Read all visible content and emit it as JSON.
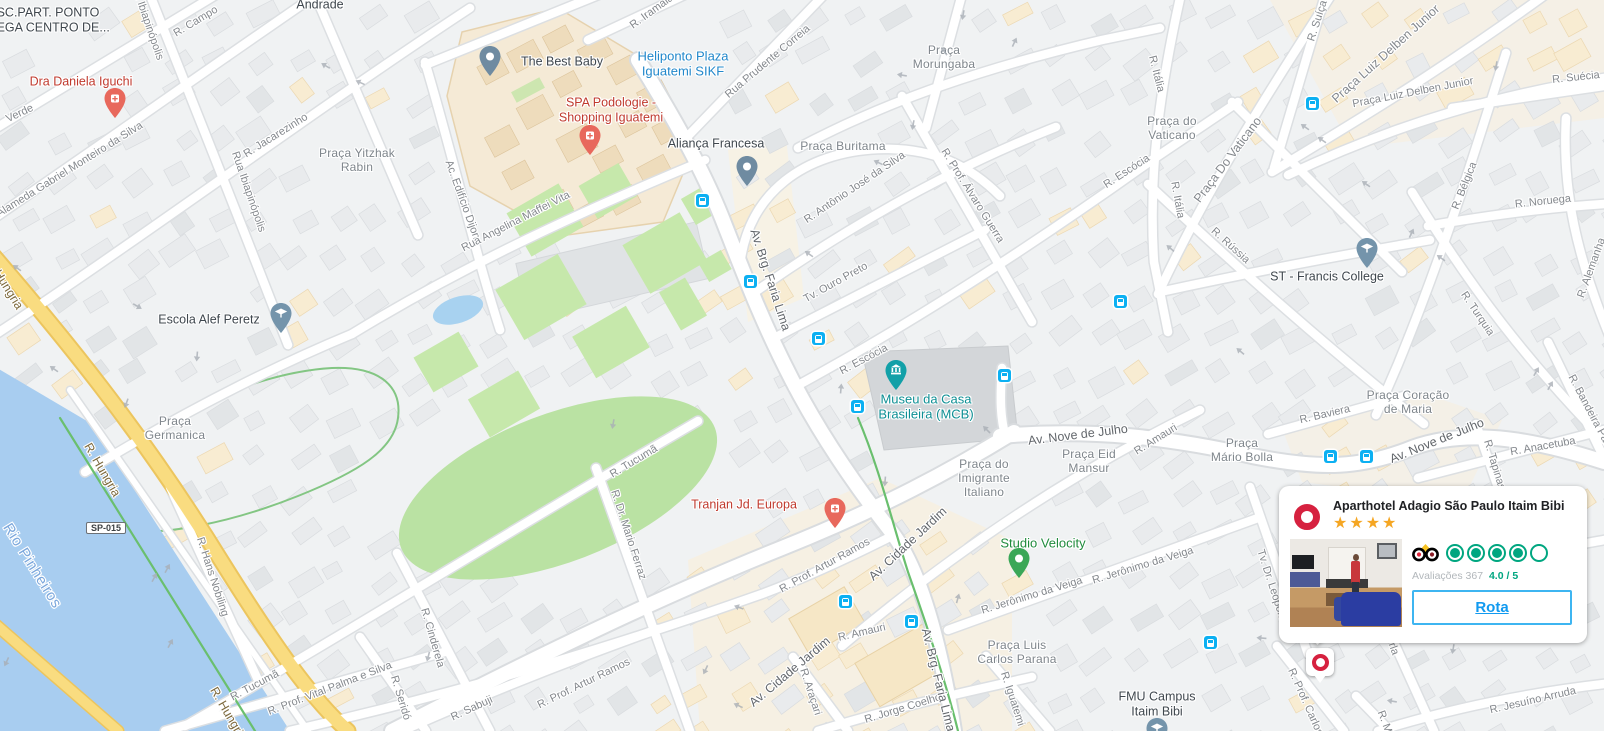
{
  "map": {
    "colors": {
      "land": "#f0f2f3",
      "water": "#a8cdf0",
      "park": "#bae2a3",
      "road_yellow": "#f9dc80",
      "transit_blue": "#0cb0f2",
      "poi_red": "#c03a2e",
      "poi_blue": "#2288cb",
      "poi_teal": "#0e8f94",
      "poi_green": "#208b3d",
      "pin_health": "#e8685c",
      "pin_gray": "#6f8ba1",
      "pin_school": "#7494ab",
      "pin_museum": "#12a0a8",
      "pin_green": "#3aa757",
      "adagio_red": "#d6213f"
    },
    "route_shield": {
      "text": "SP-015",
      "x": 106,
      "y": 528
    },
    "labels": [
      {
        "t": "R. Campo",
        "x": 196,
        "y": 22,
        "rot": -31,
        "cls": "st"
      },
      {
        "t": "Verde",
        "x": 20,
        "y": 114,
        "rot": -25,
        "cls": "st"
      },
      {
        "t": "Alameda Gabriel Monteiro da Silva",
        "x": 70,
        "y": 170,
        "rot": -32,
        "cls": "st"
      },
      {
        "t": "R. Jacarezinho",
        "x": 276,
        "y": 136,
        "rot": -32,
        "cls": "st"
      },
      {
        "t": "Rua Ibiapinópolis",
        "x": 248,
        "y": 192,
        "rot": 71,
        "cls": "st"
      },
      {
        "t": "Rua Ibiapinópolis",
        "x": 146,
        "y": 20,
        "rot": 71,
        "cls": "st"
      },
      {
        "t": "Ac. Edifício Dijon",
        "x": 462,
        "y": 200,
        "rot": 70,
        "cls": "st"
      },
      {
        "t": "Rua Angelina Maffei Vita",
        "x": 516,
        "y": 222,
        "rot": -27,
        "cls": "st"
      },
      {
        "t": "R. Iramaia",
        "x": 652,
        "y": 12,
        "rot": -36,
        "cls": "st"
      },
      {
        "t": "Rua Prudente Correia",
        "x": 768,
        "y": 62,
        "rot": -40,
        "cls": "st"
      },
      {
        "t": "R. Antônio José da Silva",
        "x": 855,
        "y": 188,
        "rot": -34,
        "cls": "st"
      },
      {
        "t": "R. Prof. Álvaro Guerra",
        "x": 972,
        "y": 196,
        "rot": 58,
        "cls": "st"
      },
      {
        "t": "Tv. Ouro Preto",
        "x": 836,
        "y": 283,
        "rot": -29,
        "cls": "st"
      },
      {
        "t": "R. Escócia",
        "x": 864,
        "y": 360,
        "rot": -28,
        "cls": "st"
      },
      {
        "t": "R. Escócia",
        "x": 1127,
        "y": 172,
        "rot": -33,
        "cls": "st"
      },
      {
        "t": "R. Rússia",
        "x": 1230,
        "y": 246,
        "rot": 42,
        "cls": "st"
      },
      {
        "t": "R. Itália",
        "x": 1156,
        "y": 74,
        "rot": 76,
        "cls": "st"
      },
      {
        "t": "R. Itália",
        "x": 1177,
        "y": 200,
        "rot": 80,
        "cls": "st"
      },
      {
        "t": "Praça Do Vaticano",
        "x": 1228,
        "y": 160,
        "rot": -53,
        "fs": 12.5,
        "cls": "st"
      },
      {
        "t": "Praça Luiz Delben Junior",
        "x": 1386,
        "y": 54,
        "rot": -42,
        "fs": 12.5,
        "cls": "st"
      },
      {
        "t": "Praça Luiz Delben Junior",
        "x": 1413,
        "y": 93,
        "rot": -11,
        "cls": "st"
      },
      {
        "t": "R. Suíça",
        "x": 1318,
        "y": 21,
        "rot": -72,
        "cls": "st"
      },
      {
        "t": "R. Suécia",
        "x": 1576,
        "y": 78,
        "rot": -6,
        "cls": "st"
      },
      {
        "t": "R. Bélgica",
        "x": 1465,
        "y": 186,
        "rot": -68,
        "cls": "st"
      },
      {
        "t": "R. Noruega",
        "x": 1543,
        "y": 202,
        "rot": -6,
        "cls": "st"
      },
      {
        "t": "R. Turquia",
        "x": 1477,
        "y": 314,
        "rot": 56,
        "cls": "st"
      },
      {
        "t": "R. Alemanha",
        "x": 1592,
        "y": 268,
        "rot": -70,
        "cls": "st"
      },
      {
        "t": "R. Baviera",
        "x": 1325,
        "y": 415,
        "rot": -13,
        "cls": "st"
      },
      {
        "t": "R. Amauri",
        "x": 1156,
        "y": 440,
        "rot": -32,
        "cls": "st"
      },
      {
        "t": "R. Amauri",
        "x": 862,
        "y": 633,
        "rot": -13,
        "cls": "st"
      },
      {
        "t": "R. Jerônimo da Veiga",
        "x": 1032,
        "y": 596,
        "rot": -17,
        "cls": "st"
      },
      {
        "t": "R. Jerônimo da Veiga",
        "x": 1143,
        "y": 566,
        "rot": -17,
        "cls": "st"
      },
      {
        "t": "R. Iguatemi",
        "x": 1012,
        "y": 699,
        "rot": 72,
        "cls": "st"
      },
      {
        "t": "R. Araçari",
        "x": 810,
        "y": 692,
        "rot": 72,
        "cls": "st"
      },
      {
        "t": "R. Jorge Coelho",
        "x": 903,
        "y": 709,
        "rot": -17,
        "cls": "st"
      },
      {
        "t": "Tv. Dr. Leopoldo",
        "x": 1272,
        "y": 588,
        "rot": 72,
        "cls": "st"
      },
      {
        "t": "R. Prof. Carlos",
        "x": 1305,
        "y": 702,
        "rot": 66,
        "cls": "st"
      },
      {
        "t": "R. Jesuíno Arruda",
        "x": 1533,
        "y": 701,
        "rot": -13,
        "cls": "st"
      },
      {
        "t": "R. M",
        "x": 1384,
        "y": 722,
        "rot": 70,
        "cls": "st"
      },
      {
        "t": "rla",
        "x": 1393,
        "y": 649,
        "rot": 70,
        "cls": "st"
      },
      {
        "t": "R. Anacetuba",
        "x": 1543,
        "y": 447,
        "rot": -10,
        "cls": "st"
      },
      {
        "t": "R. Tapinas",
        "x": 1494,
        "y": 465,
        "rot": 73,
        "cls": "st"
      },
      {
        "t": "R. Bandeira Paulista",
        "x": 1594,
        "y": 420,
        "rot": 62,
        "cls": "st"
      },
      {
        "t": "R. Tucumã",
        "x": 634,
        "y": 462,
        "rot": -31,
        "cls": "st"
      },
      {
        "t": "R. Tucumã",
        "x": 255,
        "y": 686,
        "rot": -28,
        "cls": "st"
      },
      {
        "t": "R. Dr. Mario Ferraz",
        "x": 628,
        "y": 535,
        "rot": 72,
        "cls": "st"
      },
      {
        "t": "R. Cinderela",
        "x": 432,
        "y": 638,
        "rot": 74,
        "cls": "st"
      },
      {
        "t": "R. Seridó",
        "x": 400,
        "y": 698,
        "rot": 73,
        "cls": "st"
      },
      {
        "t": "R. Sabuji",
        "x": 472,
        "y": 709,
        "rot": -25,
        "cls": "st"
      },
      {
        "t": "R. Prof. Artur Ramos",
        "x": 584,
        "y": 684,
        "rot": -26,
        "cls": "st"
      },
      {
        "t": "R. Prof. Artur Ramos",
        "x": 825,
        "y": 566,
        "rot": -29,
        "cls": "st"
      },
      {
        "t": "R. Prof. Vital Palma e Silva",
        "x": 330,
        "y": 689,
        "rot": -21,
        "cls": "st"
      },
      {
        "t": "R. Hans Nobiling",
        "x": 212,
        "y": 577,
        "rot": 72,
        "cls": "st"
      },
      {
        "t": "Av. Brg. Faria Lima",
        "x": 770,
        "y": 280,
        "rot": 72,
        "cls": "stb"
      },
      {
        "t": "Av. Brg. Faria Lima",
        "x": 938,
        "y": 680,
        "rot": 76,
        "cls": "stb"
      },
      {
        "t": "Av. Cidade Jardim",
        "x": 908,
        "y": 544,
        "rot": -43,
        "cls": "stb"
      },
      {
        "t": "Av. Cidade Jardim",
        "x": 790,
        "y": 672,
        "rot": -40,
        "cls": "stb"
      },
      {
        "t": "Av. Nove de Julho",
        "x": 1078,
        "y": 435,
        "rot": -7,
        "cls": "stb"
      },
      {
        "t": "Av. Nove de Julho",
        "x": 1437,
        "y": 441,
        "rot": -22,
        "cls": "stb"
      },
      {
        "t": "R. Hungria",
        "x": 102,
        "y": 470,
        "rot": 60,
        "cls": "sty"
      },
      {
        "t": "R. Hungria",
        "x": 228,
        "y": 714,
        "rot": 60,
        "cls": "sty"
      },
      {
        "t": "R. Hungria",
        "x": 4,
        "y": 283,
        "rot": 58,
        "cls": "sty"
      },
      {
        "t": "Rio Pinheiros",
        "x": 32,
        "y": 566,
        "rot": 58,
        "cls": "wat"
      },
      {
        "lines": [
          "Praça Yitzhak",
          "Rabin"
        ],
        "x": 357,
        "y": 160,
        "cls": "ar"
      },
      {
        "lines": [
          "Praça",
          "Morungaba"
        ],
        "x": 944,
        "y": 57,
        "cls": "ar"
      },
      {
        "t": "Praça Buritama",
        "x": 843,
        "y": 146,
        "cls": "ar"
      },
      {
        "lines": [
          "Praça do",
          "Vaticano"
        ],
        "x": 1172,
        "y": 128,
        "cls": "ar"
      },
      {
        "lines": [
          "Praça Coração",
          "de Maria"
        ],
        "x": 1408,
        "y": 402,
        "cls": "ar"
      },
      {
        "lines": [
          "Praça",
          "Germanica"
        ],
        "x": 175,
        "y": 428,
        "cls": "ar"
      },
      {
        "lines": [
          "Praça do",
          "Imigrante",
          "Italiano"
        ],
        "x": 984,
        "y": 478,
        "cls": "ar"
      },
      {
        "lines": [
          "Praça Eid",
          "Mansur"
        ],
        "x": 1089,
        "y": 461,
        "cls": "ar"
      },
      {
        "lines": [
          "Praça",
          "Mário Bolla"
        ],
        "x": 1242,
        "y": 450,
        "cls": "ar"
      },
      {
        "lines": [
          "Praça Luis",
          "Carlos Parana"
        ],
        "x": 1017,
        "y": 652,
        "cls": "ar"
      },
      {
        "t": "The Best Baby",
        "x": 562,
        "y": 62,
        "cls": "poi"
      },
      {
        "t": "Aliança Francesa",
        "x": 716,
        "y": 144,
        "cls": "poi"
      },
      {
        "t": "Escola Alef Peretz",
        "x": 209,
        "y": 320,
        "cls": "poi"
      },
      {
        "t": "ST - Francis College",
        "x": 1327,
        "y": 277,
        "cls": "poi"
      },
      {
        "lines": [
          "FMU Campus",
          "Itaim Bibi"
        ],
        "x": 1157,
        "y": 704,
        "cls": "poi"
      },
      {
        "t": "Andrade",
        "x": 320,
        "y": 5,
        "cls": "poi"
      },
      {
        "lines": [
          "SC.PART. PONTO",
          "MEGA CENTRO DE..."
        ],
        "x": 48,
        "y": 20,
        "cls": "poi"
      },
      {
        "t": "Dra Daniela Iguchi",
        "x": 81,
        "y": 82,
        "cls": "poir"
      },
      {
        "lines": [
          "SPA Podologie -",
          "Shopping Iguatemi"
        ],
        "x": 611,
        "y": 110,
        "cls": "poir"
      },
      {
        "t": "Tranjan Jd. Europa",
        "x": 744,
        "y": 505,
        "cls": "poir"
      },
      {
        "lines": [
          "Heliponto Plaza",
          "Iguatemi SIKF"
        ],
        "x": 683,
        "y": 64,
        "cls": "poib"
      },
      {
        "lines": [
          "Museu da Casa",
          "Brasileira (MCB)"
        ],
        "x": 926,
        "y": 407,
        "cls": "poit"
      },
      {
        "t": "Studio Velocity",
        "x": 1043,
        "y": 543,
        "cls": "poig"
      }
    ],
    "markers": [
      {
        "type": "health",
        "x": 115,
        "y": 118,
        "name": "doctor-pin-icon"
      },
      {
        "type": "health",
        "x": 590,
        "y": 155,
        "name": "spa-pin-icon"
      },
      {
        "type": "health",
        "x": 835,
        "y": 528,
        "name": "clinic-pin-icon"
      },
      {
        "type": "dot",
        "x": 490,
        "y": 76,
        "name": "poi-pin-icon"
      },
      {
        "type": "dot",
        "x": 747,
        "y": 186,
        "name": "poi-pin-icon"
      },
      {
        "type": "school",
        "x": 281,
        "y": 333,
        "name": "school-pin-icon"
      },
      {
        "type": "school",
        "x": 1367,
        "y": 268,
        "name": "school-pin-icon"
      },
      {
        "type": "school",
        "x": 1157,
        "y": 748,
        "name": "school-pin-icon"
      },
      {
        "type": "museum",
        "x": 896,
        "y": 390,
        "name": "museum-pin-icon"
      },
      {
        "type": "green",
        "x": 1019,
        "y": 578,
        "name": "gym-pin-icon"
      }
    ],
    "transit_stops": [
      [
        702,
        200
      ],
      [
        750,
        281
      ],
      [
        818,
        338
      ],
      [
        857,
        406
      ],
      [
        1004,
        375
      ],
      [
        1120,
        301
      ],
      [
        1312,
        103
      ],
      [
        1330,
        456
      ],
      [
        1366,
        456
      ],
      [
        845,
        601
      ],
      [
        911,
        621
      ],
      [
        1210,
        642
      ]
    ],
    "arrows": [
      [
        323,
        70,
        210
      ],
      [
        358,
        87,
        205
      ],
      [
        968,
        16,
        100
      ],
      [
        940,
        54,
        235
      ],
      [
        876,
        167,
        205
      ],
      [
        806,
        258,
        215
      ],
      [
        1010,
        40,
        -65
      ],
      [
        901,
        80,
        190
      ],
      [
        918,
        126,
        100
      ],
      [
        1302,
        131,
        215
      ],
      [
        1319,
        144,
        215
      ],
      [
        1363,
        188,
        215
      ],
      [
        1501,
        67,
        100
      ],
      [
        1407,
        231,
        -65
      ],
      [
        1438,
        262,
        215
      ],
      [
        1532,
        369,
        -60
      ],
      [
        1546,
        383,
        -60
      ],
      [
        1167,
        252,
        220
      ],
      [
        1237,
        355,
        220
      ],
      [
        836,
        388,
        -85
      ],
      [
        983,
        433,
        225
      ],
      [
        890,
        482,
        95
      ],
      [
        953,
        597,
        -75
      ],
      [
        710,
        672,
        115
      ],
      [
        736,
        710,
        205
      ],
      [
        737,
        612,
        200
      ],
      [
        433,
        658,
        105
      ],
      [
        618,
        425,
        100
      ],
      [
        51,
        373,
        215
      ],
      [
        140,
        302,
        30
      ],
      [
        131,
        405,
        110
      ],
      [
        202,
        357,
        95
      ],
      [
        14,
        272,
        215
      ],
      [
        1261,
        643,
        185
      ],
      [
        1458,
        650,
        100
      ],
      [
        1391,
        706,
        190
      ],
      [
        150,
        575,
        -62
      ],
      [
        163,
        566,
        -62
      ],
      [
        166,
        641,
        -62
      ],
      [
        11,
        664,
        115
      ]
    ]
  },
  "card": {
    "title": "Aparthotel Adagio São Paulo Itaim Bibi",
    "star_rating": 4,
    "logo": {
      "name": "adagio-ring-logo",
      "color": "#d6213f"
    },
    "tripadvisor": {
      "icon": "tripadvisor-owl-icon",
      "bubbles_filled": 4,
      "bubbles_total": 5,
      "reviews_label": "Avaliações",
      "reviews_count": "367",
      "score": "4.0 / 5"
    },
    "button_label": "Rota"
  }
}
